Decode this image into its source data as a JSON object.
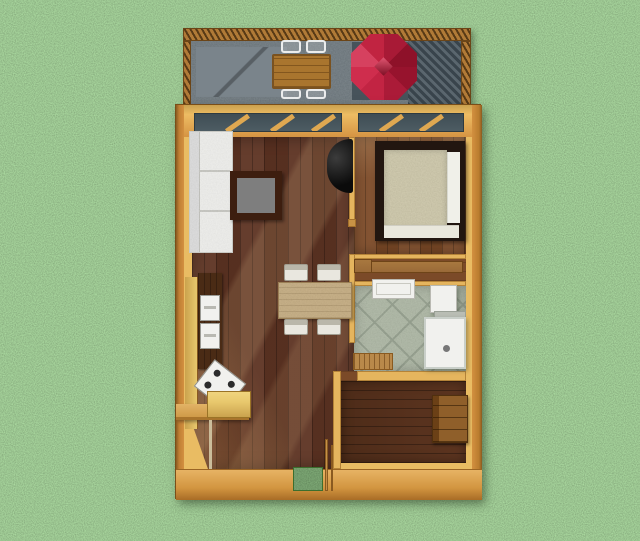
{
  "title": "3D top-down floor plan rendering of a small one-bedroom house with front deck, lawn around it",
  "colors": {
    "grass_base": "#6fa55a",
    "deck_floor": "#5f6b72",
    "deck_rug": "#7a848b",
    "deck_shade": "#47535b",
    "screen_stripe_dark": "#39444c",
    "screen_stripe_light": "#5a666e",
    "railing_wood": "#b17a37",
    "umbrella_red": "#c22340",
    "outdoor_table_wood": "#a9752e",
    "wall_outer": "#d39040",
    "wall_inner": "#e5b55e",
    "wall_face_light": "#e9bc63",
    "window_glass": "#4d5c63",
    "living_floor": "#5d3322",
    "bedroom_floor": "#7c4a27",
    "backroom_floor": "#4e2c19",
    "closet_floor": "#7b4a28",
    "bath_tile": "#a9b49f",
    "bath_tile_line": "#8c9884",
    "fixture_white": "#f1f1ee",
    "bed_frame": "#221610",
    "mattress": "#cdc6a4",
    "stove_black": "#161616",
    "counter_yellow": "#e8c86d",
    "cabinet_brown": "#4a2b15",
    "dresser_wood": "#8f5f2a",
    "doormat_green": "#4f8a3b",
    "coffee_table_top": "#7e7e7e",
    "coffee_table_frame": "#3d1e0f",
    "dining_table": "#c3a97b",
    "chair_white": "#e9e7df",
    "shelf_wood": "#9a6a38",
    "mat_wood": "#b9894a"
  },
  "scene": {
    "areas": [
      {
        "id": "deck",
        "label": "Deck / patio",
        "items": [
          "wood-railing",
          "privacy-screen",
          "concrete-floor",
          "floor-rug",
          "outdoor-table",
          "red-patio-umbrella"
        ],
        "chairs": 4
      },
      {
        "id": "living",
        "label": "Living / dining / kitchen",
        "items": [
          "white-sofa",
          "coffee-table",
          "black-stove",
          "dining-table",
          "kitchen-counter",
          "tall-cabinet",
          "oven",
          "microwave",
          "gas-range",
          "island-counter",
          "front-door-mat"
        ],
        "chairs": 4
      },
      {
        "id": "bedroom",
        "label": "Bedroom",
        "items": [
          "double-bed",
          "pillow",
          "window"
        ]
      },
      {
        "id": "closet",
        "label": "Closet passage",
        "items": [
          "storage-shelf",
          "storage-box"
        ]
      },
      {
        "id": "bathroom",
        "label": "Bathroom",
        "items": [
          "bathtub-sink",
          "wall-cabinet",
          "shower-enclosure",
          "wooden-bath-mat"
        ]
      },
      {
        "id": "backroom",
        "label": "Back room",
        "items": [
          "wooden-dresser"
        ]
      }
    ],
    "counts": {
      "deck_chairs": 4,
      "dining_chairs": 4,
      "rooms": 5
    }
  }
}
